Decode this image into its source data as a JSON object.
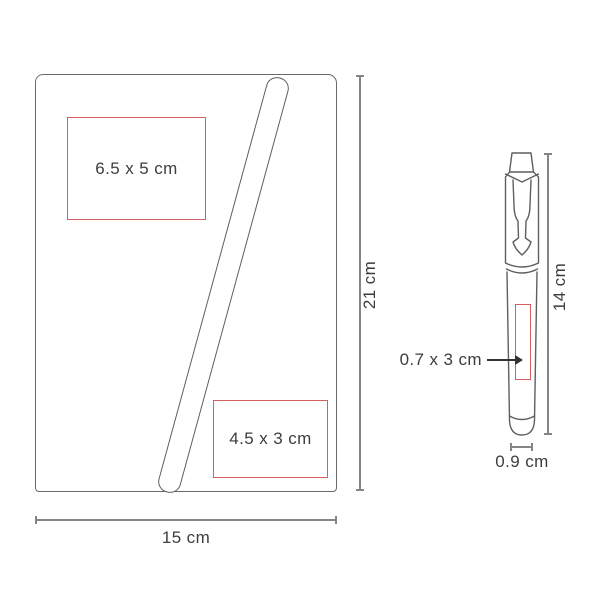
{
  "diagram_title": "product dimensions diagram",
  "notebook": {
    "print_area_top": {
      "label": "6.5 x 5 cm"
    },
    "print_area_bottom": {
      "label": "4.5 x 3 cm"
    },
    "width_dim": "15 cm",
    "height_dim": "21 cm"
  },
  "pen": {
    "height_dim": "14 cm",
    "diameter_dim": "0.9 cm",
    "print_area": {
      "label": "0.7 x 3 cm"
    }
  },
  "colors": {
    "outline_gray": "#6a6a6a",
    "dimension_gray": "#858585",
    "print_area_red": "#d66060",
    "text": "#3d3d3d",
    "background": "#ffffff"
  }
}
